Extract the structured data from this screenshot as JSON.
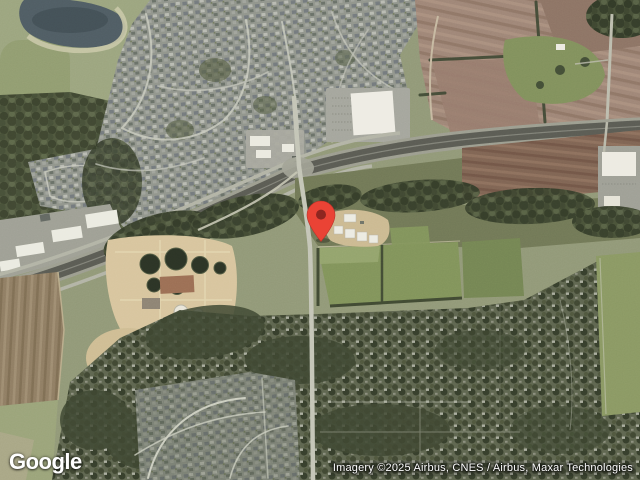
{
  "branding": {
    "logo_text": "Google"
  },
  "attribution": {
    "text": "Imagery ©2025 Airbus, CNES / Airbus, Maxar Technologies"
  },
  "marker": {
    "name": "red-location-pin",
    "color": "#EA4335",
    "dot_color": "#8E2620"
  },
  "map": {
    "view": "satellite"
  }
}
